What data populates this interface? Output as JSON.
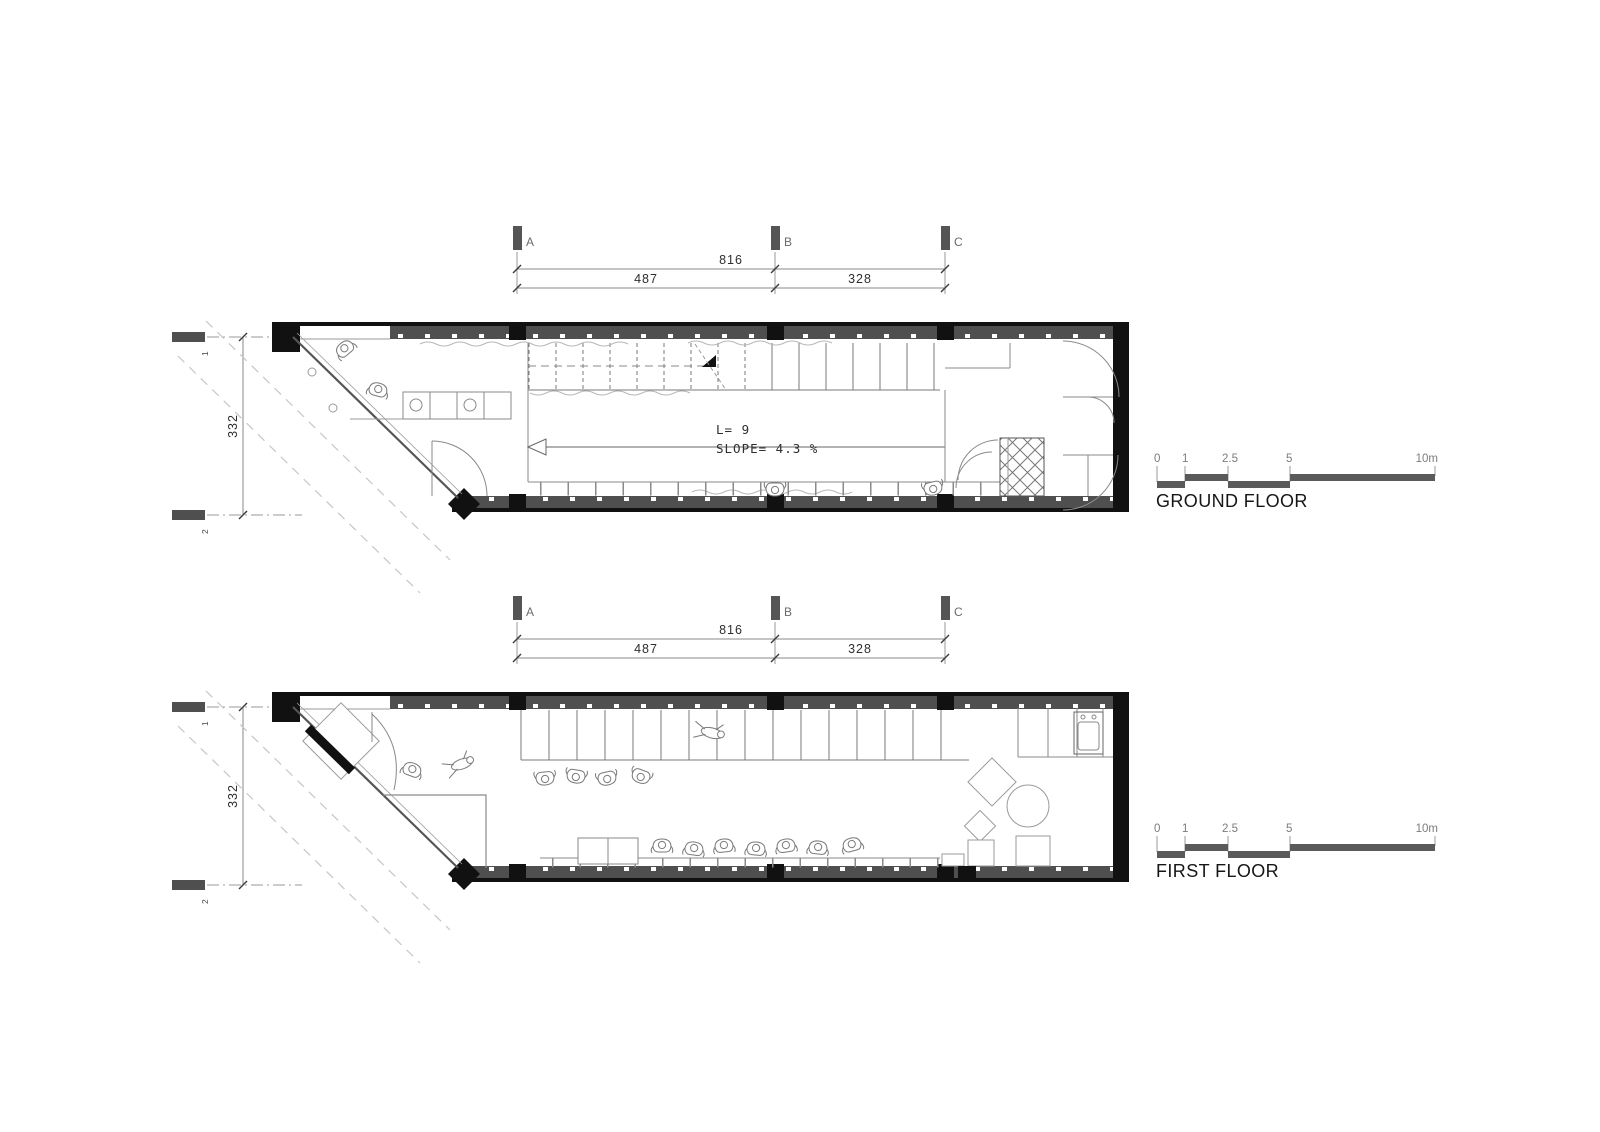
{
  "title": "Floor plans drawing",
  "colors": {
    "wall_band": "#4f4f4f",
    "solid_black": "#111111",
    "dim_line": "#8a8a8a",
    "dim_text": "#2e2e2e",
    "scale_bar": "#5a5a5a",
    "dashed_line": "#c6c6c6",
    "drawing_line": "#888888"
  },
  "grid": {
    "col_a": "A",
    "col_b": "B",
    "col_c": "C",
    "row_1": "1",
    "row_2": "2"
  },
  "dimensions": {
    "overall_width": "816",
    "bay_left": "487",
    "bay_right": "328",
    "depth": "332"
  },
  "ramp": {
    "length": "L=  9",
    "slope": "SLOPE=  4.3  %"
  },
  "scale_bar": {
    "tick_0": "0",
    "tick_1": "1",
    "tick_2_5": "2.5",
    "tick_5": "5",
    "tick_10": "10m"
  },
  "floors": {
    "ground_label": "GROUND FLOOR",
    "first_label": "FIRST FLOOR"
  }
}
